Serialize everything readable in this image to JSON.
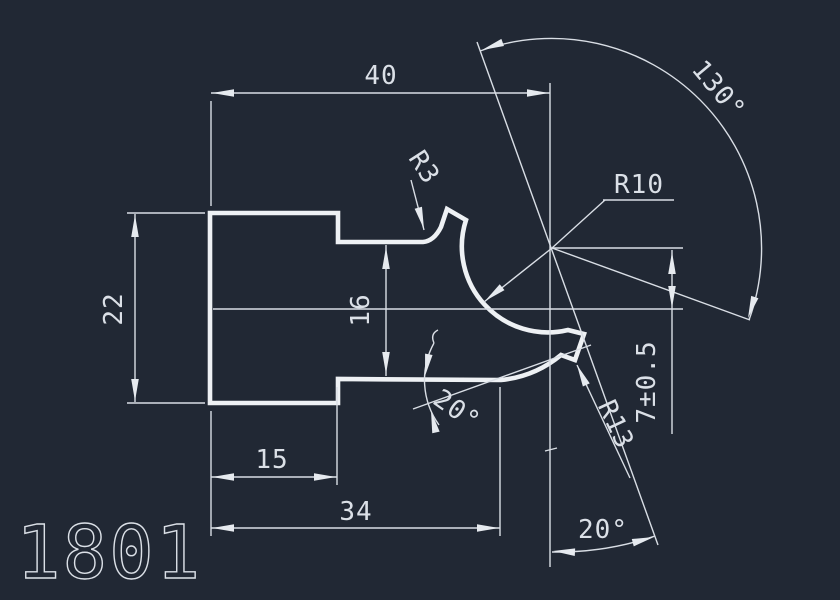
{
  "drawing": {
    "type": "cad-part-profile",
    "part_number": "1801",
    "background_color": "#212834",
    "line_color": "#e6eaef",
    "text_color": "#dbe0e7",
    "dimensions": {
      "width_top": "40",
      "height_left": "22",
      "height_slot": "16",
      "center_offset": "7±0.5",
      "fillet_radius": "R3",
      "cavity_radius": "R10",
      "lower_radius": "R13",
      "angle_large": "130°",
      "angle_slot": "20°",
      "angle_axis": "20°",
      "step_length": "15",
      "base_length": "34"
    }
  }
}
